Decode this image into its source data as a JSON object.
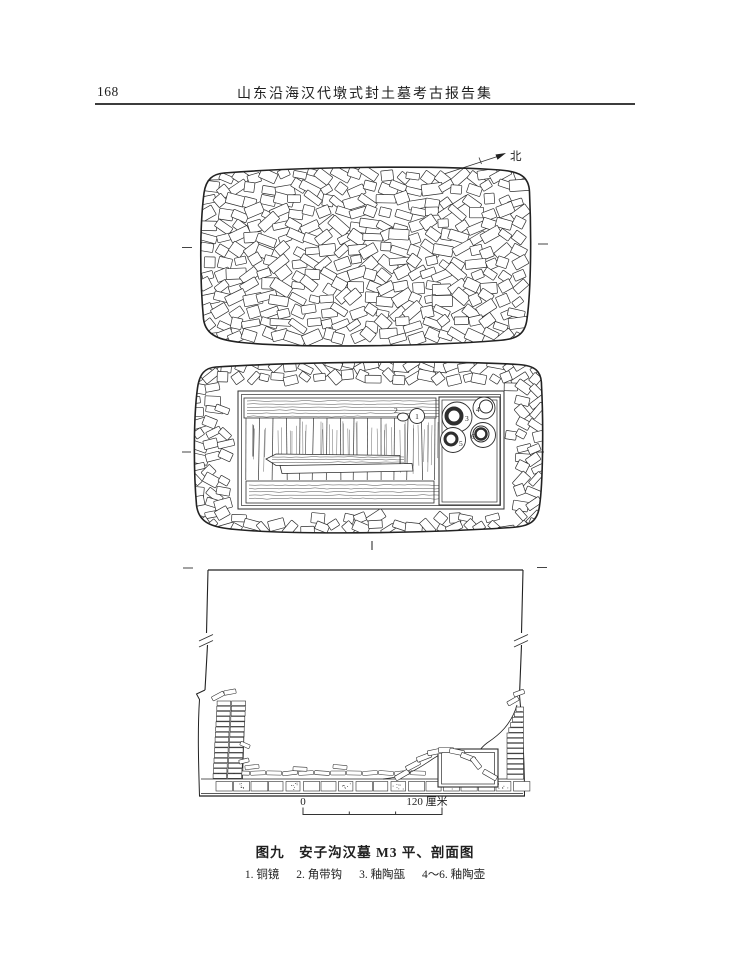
{
  "page": {
    "number": "168",
    "header_title": "山东沿海汉代墩式封土墓考古报告集"
  },
  "figure": {
    "north_label": "北",
    "caption": "图九　安子沟汉墓 M3 平、剖面图",
    "legend_items": [
      "1. 铜镜",
      "2. 角带钩",
      "3. 釉陶瓿",
      "4～6. 釉陶壶"
    ],
    "scale": {
      "start": "0",
      "end": "120 厘米"
    },
    "artifacts": {
      "a1": "1",
      "a2": "2",
      "a3": "3",
      "a4": "4",
      "a5": "5",
      "a6": "6"
    }
  },
  "colors": {
    "ink": "#2e2e2e",
    "paper": "#ffffff"
  }
}
